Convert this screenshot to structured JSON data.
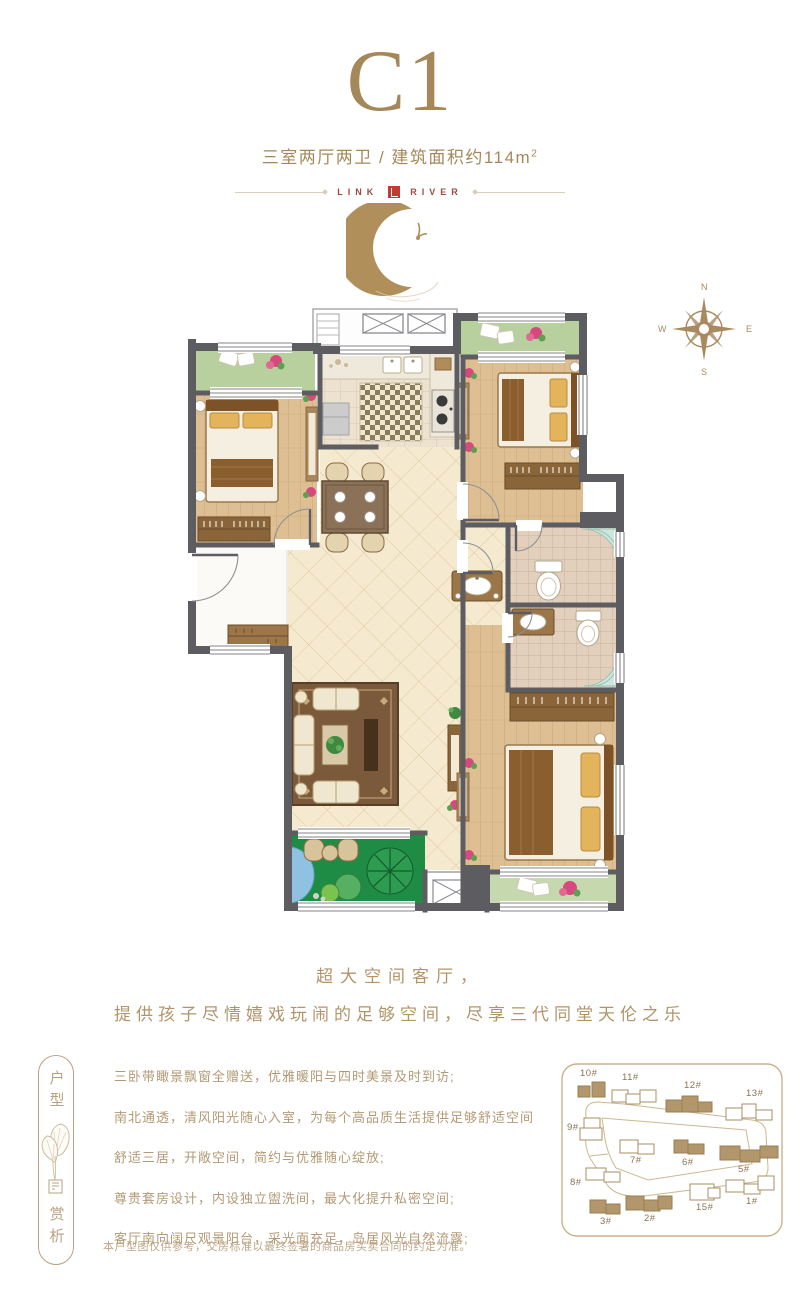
{
  "header": {
    "title": "C1",
    "subtitle_main": "三室两厅两卫 / 建筑面积约114m",
    "subtitle_sup": "2",
    "logo_left": "LINK",
    "logo_right": "RIVER"
  },
  "compass": {
    "n": "N",
    "e": "E",
    "s": "S",
    "w": "W"
  },
  "slogan": {
    "line1": "超大空间客厅，",
    "line2": "提供孩子尽情嬉戏玩闹的足够空间，尽享三代同堂天伦之乐"
  },
  "sidebar": {
    "top": "户型",
    "bottom": "赏析"
  },
  "features": [
    "三卧带瞰景飘窗全赠送，优雅暖阳与四时美景及时到访;",
    "南北通透，清风阳光随心入室，为每个高品质生活提供足够舒适空间",
    "舒适三居，开敞空间，简约与优雅随心绽放;",
    "尊贵套房设计，内设独立盥洗间，最大化提升私密空间;",
    "客厅南向阔尺观景阳台，采光面充足，岛居风光自然流露;"
  ],
  "disclaimer": "本户型图仅供参考，交房标准以最终签署的商品房买卖合同的约定为准。",
  "siteplan": {
    "buildings": [
      {
        "label": "10#",
        "filled": true
      },
      {
        "label": "11#",
        "filled": false
      },
      {
        "label": "12#",
        "filled": true
      },
      {
        "label": "13#",
        "filled": false
      },
      {
        "label": "9#",
        "filled": false
      },
      {
        "label": "7#",
        "filled": false
      },
      {
        "label": "6#",
        "filled": true
      },
      {
        "label": "5#",
        "filled": true
      },
      {
        "label": "8#",
        "filled": false
      },
      {
        "label": "3#",
        "filled": true
      },
      {
        "label": "2#",
        "filled": true
      },
      {
        "label": "15#",
        "filled": false
      },
      {
        "label": "1#",
        "filled": false
      }
    ]
  },
  "colors": {
    "accent_bronze": "#a5885a",
    "text_tan": "#b29a75",
    "logo_red": "#c23a33",
    "wall_gray": "#5d5d61",
    "balcony_green": "#b8cf9e",
    "garden_green": "#1f8c46",
    "wood_floor": "#ddbf93",
    "tile_cream": "#f5ead0"
  }
}
